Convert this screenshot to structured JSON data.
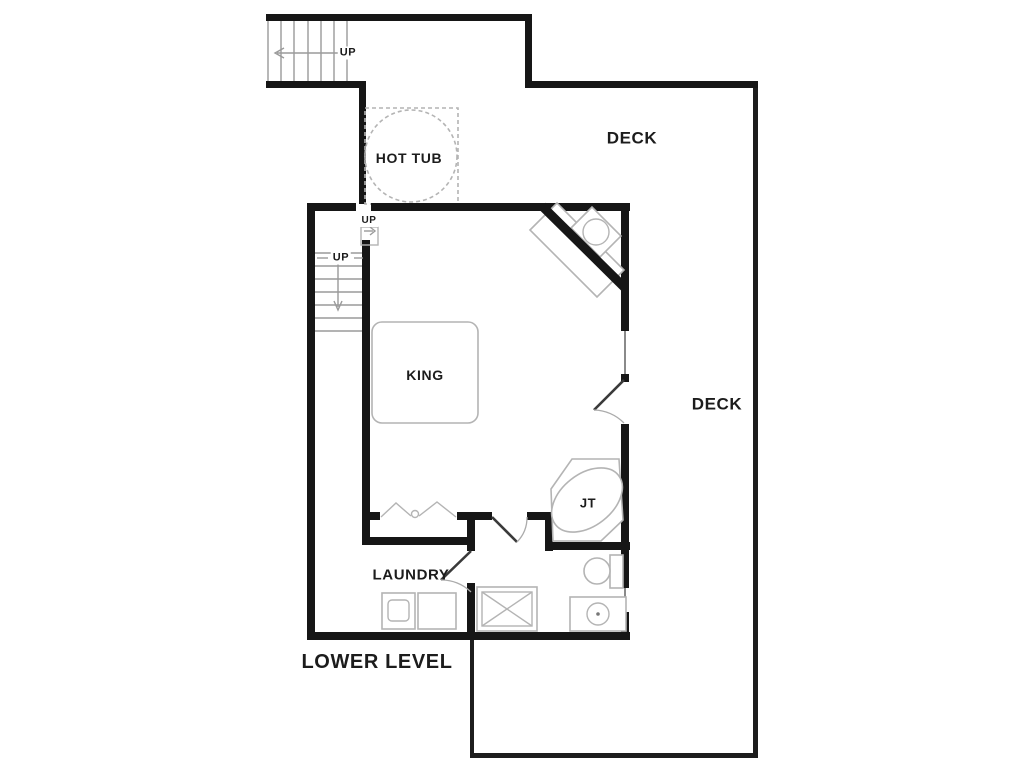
{
  "page": {
    "kind": "floor-plan",
    "level_caption": "LOWER LEVEL"
  },
  "labels": {
    "up_exterior_stairs": "UP",
    "deck_upper": "DECK",
    "hot_tub": "HOT TUB",
    "up_stair_landing": "UP",
    "up_interior_stairs": "UP",
    "king_bed": "KING",
    "deck_right": "DECK",
    "jetted_tub": "JT",
    "laundry_room": "LAUNDRY",
    "lower_level": "LOWER LEVEL"
  },
  "fixtures": [
    "exterior-staircase",
    "interior-staircase",
    "hot-tub",
    "corner-fireplace",
    "king-bed",
    "jetted-tub",
    "toilet",
    "vanity-sink",
    "shower",
    "washer",
    "dryer",
    "bifold-closet-doors",
    "deck-door",
    "laundry-door",
    "bathroom-door",
    "window"
  ],
  "colors": {
    "wall": "#161616",
    "fixture_outline": "#b4b4b4",
    "stair_tread": "#9a9a9a",
    "door": "#3a3a3a",
    "door_arc": "#ababab",
    "text": "#1c1c1c",
    "background": "#ffffff",
    "window": "#8a8a8a"
  }
}
